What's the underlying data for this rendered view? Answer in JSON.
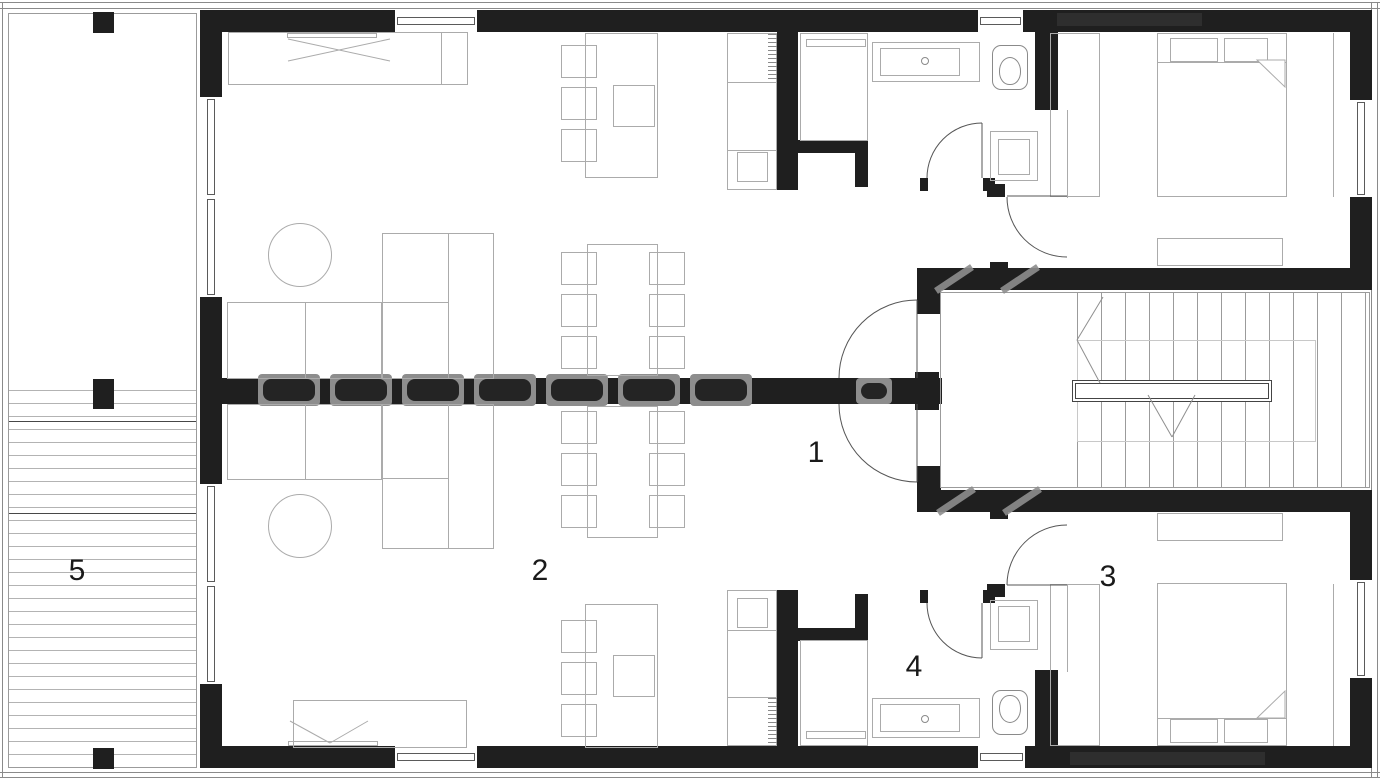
{
  "title": "Apartment floor plan",
  "labels": {
    "hall": "1",
    "living_room": "2",
    "bedroom": "3",
    "bathroom": "4",
    "terrace": "5"
  },
  "colors": {
    "wall": "#1f1f1f",
    "furniture_line": "#ababab",
    "door_line": "#555555",
    "watermark": "#8d8d8d",
    "background": "#ffffff"
  }
}
